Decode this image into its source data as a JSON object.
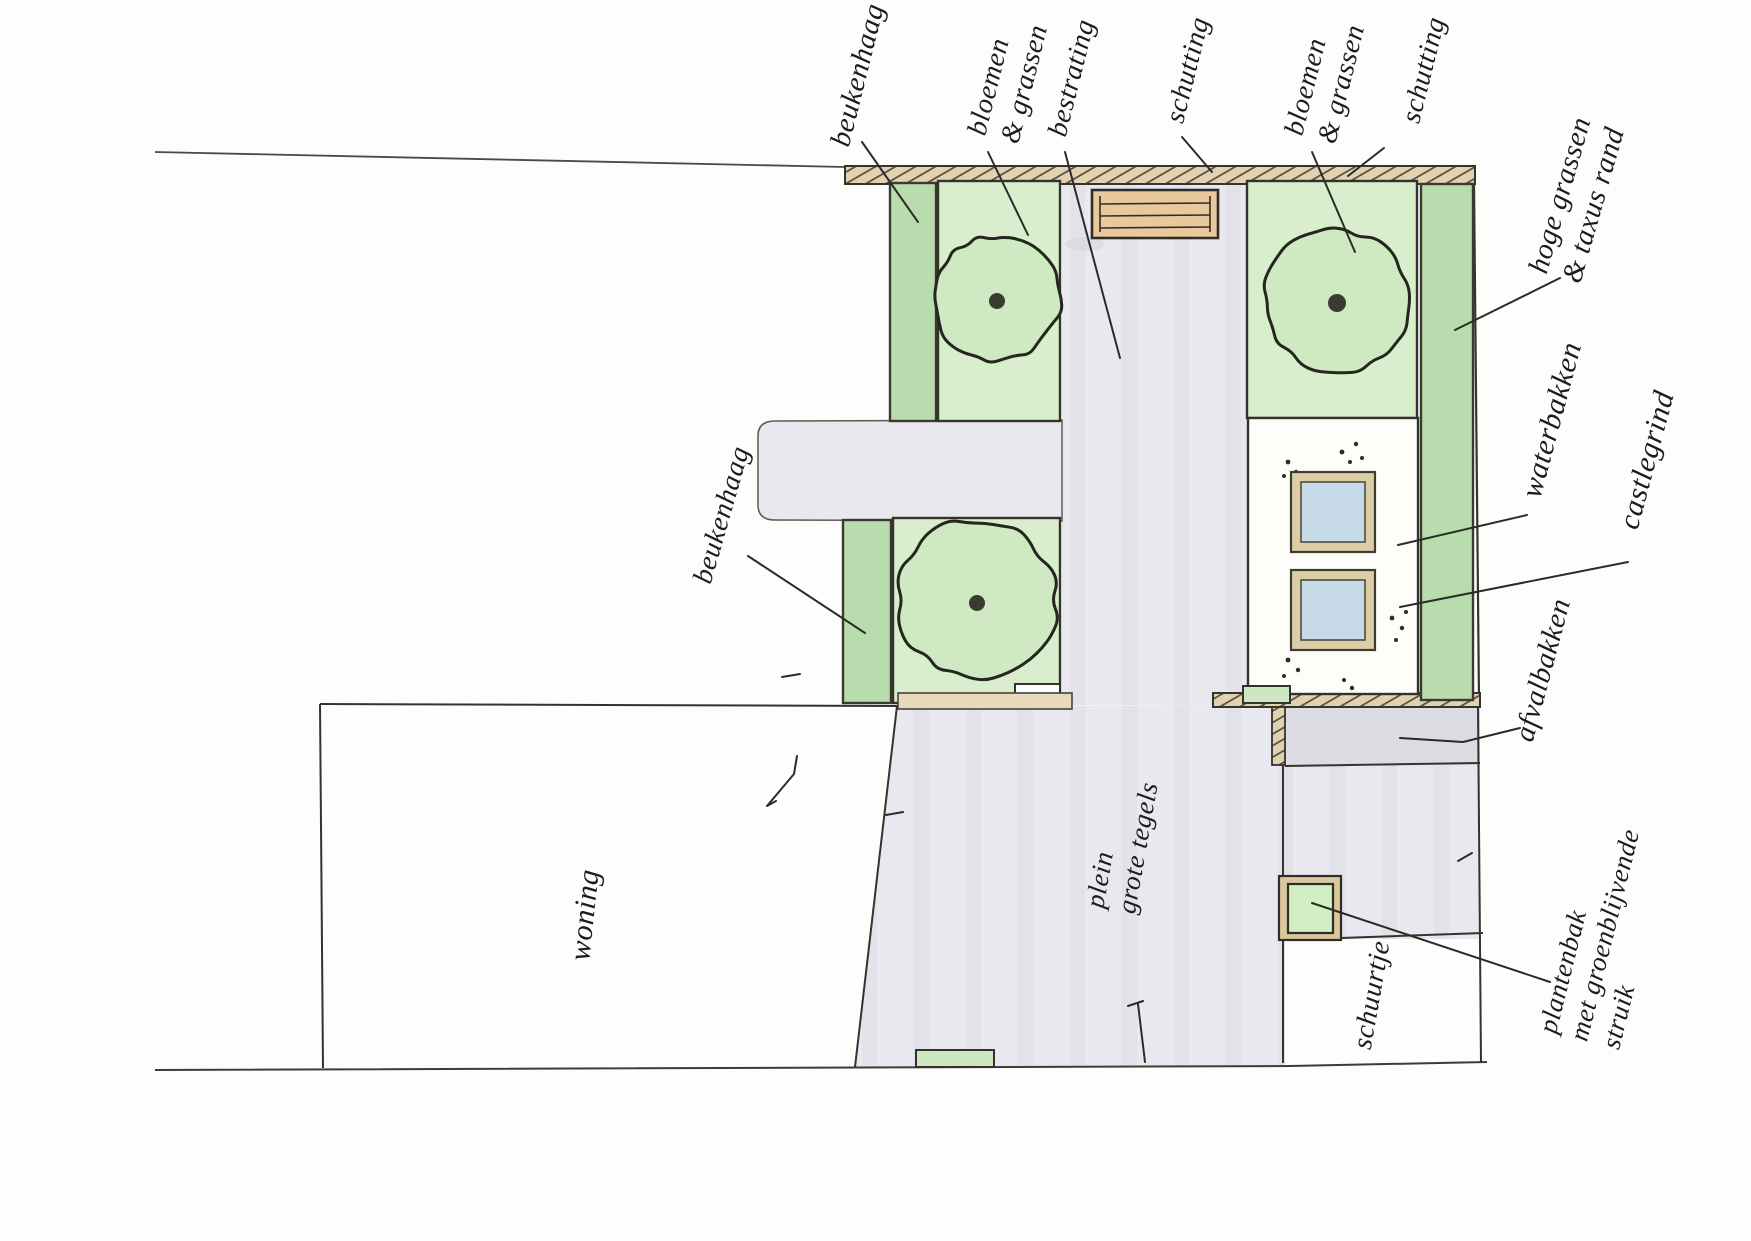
{
  "plan": {
    "colors": {
      "hedge_green": "#b9dcae",
      "bed_green": "#d9eecd",
      "tree_green": "#cfe9c2",
      "fence_tan": "#e2d2b0",
      "bench_tan": "#e9c99b",
      "paving_gray": "#e9e8ed",
      "paving_dark": "#dddce2",
      "water_blue": "#c6dbe7",
      "basin_frame_tan": "#ddcda5",
      "planter_green": "#d2eec3",
      "ink": "#2b2b28"
    },
    "labels": [
      {
        "id": "beukenhaag-top",
        "text": "beukenhaag",
        "x": 858,
        "y": 75,
        "rot": -76,
        "size": 29,
        "leader": [
          [
            862,
            142
          ],
          [
            918,
            222
          ]
        ]
      },
      {
        "id": "bloemen-grassen-left",
        "text": "bloemen\n& grassen",
        "x": 1008,
        "y": 80,
        "rot": -76,
        "size": 28,
        "leader": [
          [
            988,
            152
          ],
          [
            1028,
            235
          ]
        ]
      },
      {
        "id": "bestrating",
        "text": "bestrating",
        "x": 1072,
        "y": 78,
        "rot": -76,
        "size": 28,
        "leader": [
          [
            1065,
            152
          ],
          [
            1120,
            358
          ]
        ]
      },
      {
        "id": "schutting-left",
        "text": "schutting",
        "x": 1188,
        "y": 70,
        "rot": -76,
        "size": 28,
        "leader": [
          [
            1182,
            137
          ],
          [
            1212,
            172
          ]
        ]
      },
      {
        "id": "bloemen-grassen-right",
        "text": "bloemen\n& grassen",
        "x": 1325,
        "y": 80,
        "rot": -76,
        "size": 28,
        "leader": [
          [
            1312,
            152
          ],
          [
            1355,
            252
          ]
        ]
      },
      {
        "id": "schutting-right",
        "text": "schutting",
        "x": 1424,
        "y": 70,
        "rot": -76,
        "size": 28,
        "leader": [
          [
            1384,
            148
          ],
          [
            1348,
            176
          ]
        ]
      },
      {
        "id": "hoge-grassen",
        "text": "hoge grassen\n& taxus rand",
        "x": 1577,
        "y": 200,
        "rot": -74,
        "size": 29,
        "leader": [
          [
            1560,
            278
          ],
          [
            1455,
            330
          ]
        ]
      },
      {
        "id": "waterbakken",
        "text": "waterbakken",
        "x": 1552,
        "y": 420,
        "rot": -75,
        "size": 30,
        "leader": [
          [
            1527,
            515
          ],
          [
            1398,
            545
          ]
        ]
      },
      {
        "id": "castlegrind",
        "text": "castlegrind",
        "x": 1647,
        "y": 460,
        "rot": -75,
        "size": 30,
        "leader": [
          [
            1628,
            562
          ],
          [
            1400,
            607
          ]
        ]
      },
      {
        "id": "afvalbakken",
        "text": "afvalbakken",
        "x": 1543,
        "y": 670,
        "rot": -75,
        "size": 29,
        "leader": [
          [
            1520,
            728
          ],
          [
            1463,
            742
          ],
          [
            1400,
            738
          ]
        ]
      },
      {
        "id": "plantenbak",
        "text": "plantenbak\nmet groenblijvende\nstruik",
        "x": 1605,
        "y": 935,
        "rot": -76,
        "size": 27,
        "leader": [
          [
            1550,
            982
          ],
          [
            1312,
            903
          ]
        ]
      },
      {
        "id": "schuurtje",
        "text": "schuurtje",
        "x": 1372,
        "y": 995,
        "rot": -80,
        "size": 28
      },
      {
        "id": "woning",
        "text": "woning",
        "x": 585,
        "y": 915,
        "rot": -84,
        "size": 30
      },
      {
        "id": "plein",
        "text": "plein\ngrote tegels",
        "x": 1122,
        "y": 845,
        "rot": -80,
        "size": 27
      },
      {
        "id": "beukenhaag-mid",
        "text": "beukenhaag",
        "x": 722,
        "y": 515,
        "rot": -74,
        "size": 28,
        "leader": [
          [
            748,
            556
          ],
          [
            865,
            633
          ]
        ]
      }
    ],
    "trees": [
      {
        "cx": 997,
        "cy": 298,
        "r": 63,
        "seed": 11,
        "dot": 8
      },
      {
        "cx": 977,
        "cy": 600,
        "r": 79,
        "seed": 23,
        "dot": 8
      },
      {
        "cx": 1337,
        "cy": 300,
        "r": 71,
        "seed": 37,
        "dot": 9
      }
    ]
  }
}
